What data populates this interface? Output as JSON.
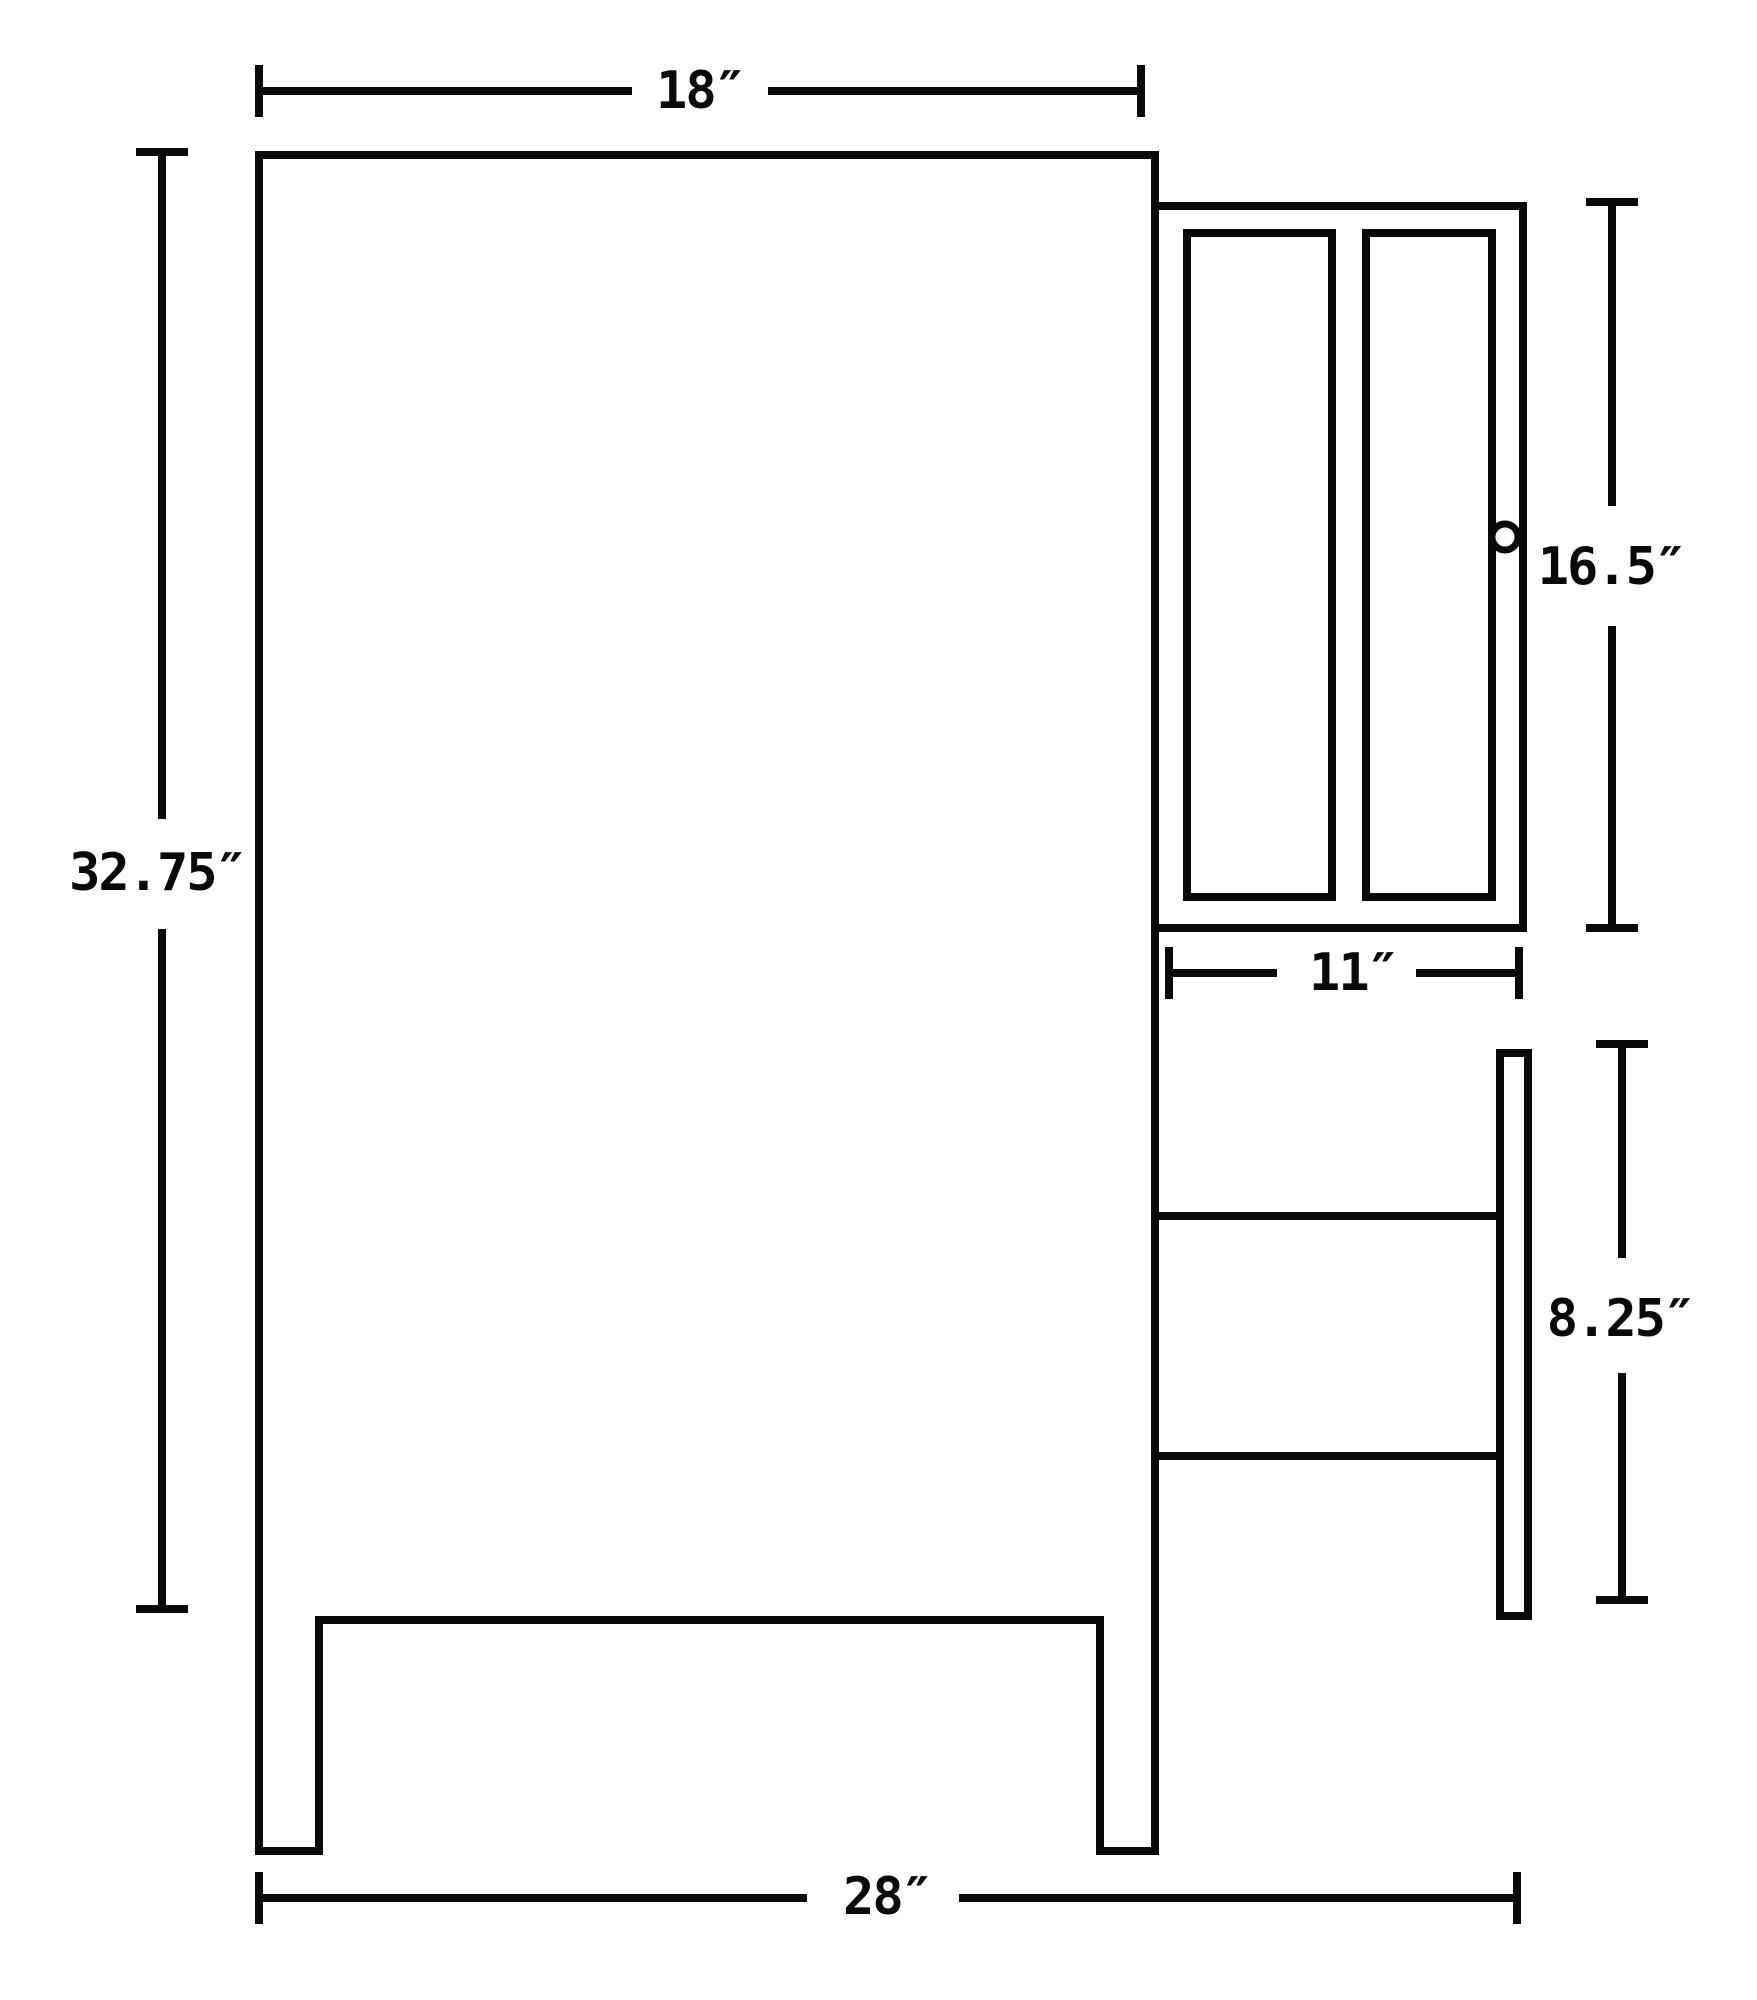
{
  "drawing": {
    "type": "cabinet-dimension-diagram",
    "units": "inches"
  },
  "colors": {
    "line": "#0a0a0a",
    "background": "#ffffff"
  },
  "dimensions": {
    "top_width": {
      "label": "18″",
      "value": 18
    },
    "left_height": {
      "label": "32.75″",
      "value": 32.75
    },
    "cabinet_height": {
      "label": "16.5″",
      "value": 16.5
    },
    "cabinet_width": {
      "label": "11″",
      "value": 11
    },
    "drawer_height": {
      "label": "8.25″",
      "value": 8.25
    },
    "bottom_width": {
      "label": "28″",
      "value": 28
    }
  }
}
